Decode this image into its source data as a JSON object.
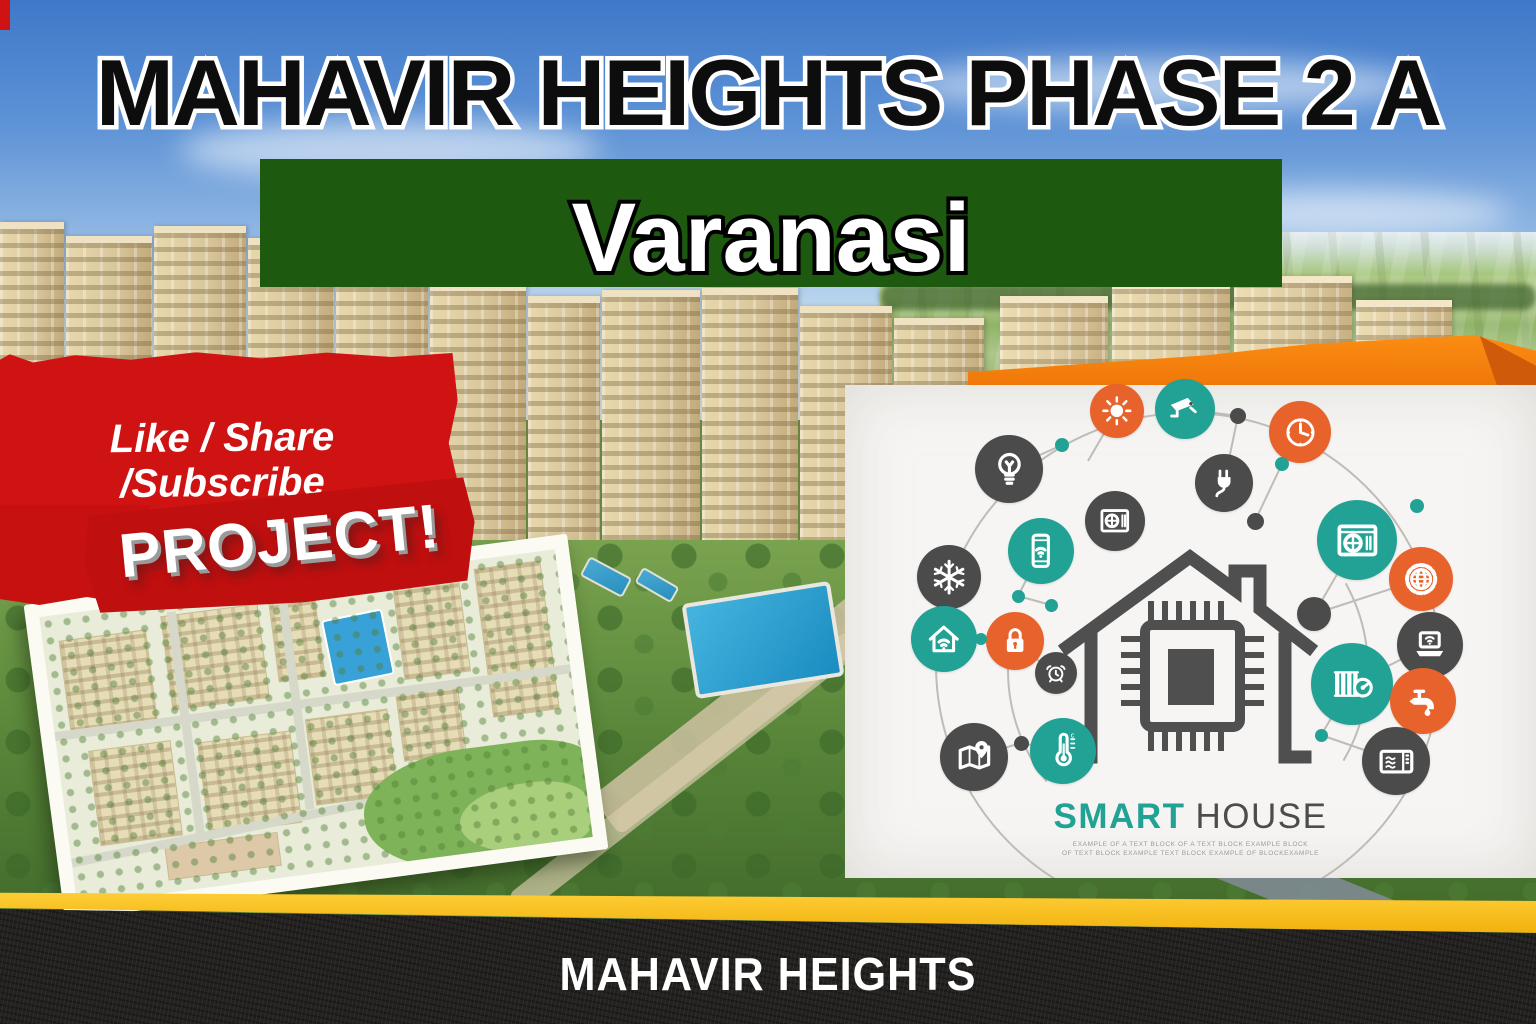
{
  "header": {
    "title": "MAHAVIR HEIGHTS PHASE 2 A"
  },
  "location_banner": {
    "text": "Varanasi",
    "bg_color": "#1d5a10"
  },
  "cta_banner": {
    "text": "Like / Share /Subscribe",
    "bg_color": "#ce1312"
  },
  "ribbon": {
    "text": "PROJECT!"
  },
  "footer": {
    "brand": "MAHAVIR HEIGHTS",
    "stripe_color": "#f3b90e",
    "bg_color": "#242220"
  },
  "smart_house": {
    "title_accent": "SMART",
    "title_rest": "HOUSE",
    "caption_line1": "EXAMPLE OF A TEXT BLOCK OF A TEXT BLOCK EXAMPLE BLOCK",
    "caption_line2": "OF TEXT BLOCK EXAMPLE TEXT BLOCK EXAMPLE OF BLOCKEXAMPLE",
    "colors": {
      "teal": "#21a295",
      "orange": "#e8622b",
      "dark": "#4b4b4b",
      "card_bg": "#f6f5f3"
    },
    "icons": [
      {
        "name": "light-bulb",
        "color": "dark",
        "x": 164,
        "y": 84,
        "d": 68
      },
      {
        "name": "sun",
        "color": "orange",
        "x": 272,
        "y": 26,
        "d": 54
      },
      {
        "name": "cctv-camera",
        "color": "teal",
        "x": 340,
        "y": 24,
        "d": 60
      },
      {
        "name": "clock",
        "color": "orange",
        "x": 455,
        "y": 47,
        "d": 62
      },
      {
        "name": "power-plug",
        "color": "dark",
        "x": 379,
        "y": 98,
        "d": 58
      },
      {
        "name": "ac-vent",
        "color": "dark",
        "x": 270,
        "y": 136,
        "d": 60
      },
      {
        "name": "smartphone-wifi",
        "color": "teal",
        "x": 196,
        "y": 166,
        "d": 66
      },
      {
        "name": "snowflake",
        "color": "dark",
        "x": 104,
        "y": 192,
        "d": 64
      },
      {
        "name": "air-conditioner",
        "color": "teal",
        "x": 512,
        "y": 155,
        "d": 80
      },
      {
        "name": "gear-globe",
        "color": "orange",
        "x": 576,
        "y": 194,
        "d": 64
      },
      {
        "name": "smart-home-wifi",
        "color": "teal",
        "x": 99,
        "y": 254,
        "d": 66
      },
      {
        "name": "padlock",
        "color": "orange",
        "x": 170,
        "y": 256,
        "d": 58
      },
      {
        "name": "alarm-clock",
        "color": "dark",
        "x": 211,
        "y": 288,
        "d": 42
      },
      {
        "name": "map-location",
        "color": "dark",
        "x": 129,
        "y": 372,
        "d": 68
      },
      {
        "name": "thermometer",
        "color": "teal",
        "x": 218,
        "y": 366,
        "d": 66
      },
      {
        "name": "radiator",
        "color": "teal",
        "x": 507,
        "y": 299,
        "d": 82
      },
      {
        "name": "laptop-wifi",
        "color": "dark",
        "x": 585,
        "y": 260,
        "d": 66
      },
      {
        "name": "water-tap",
        "color": "orange",
        "x": 578,
        "y": 316,
        "d": 66
      },
      {
        "name": "microwave",
        "color": "dark",
        "x": 551,
        "y": 376,
        "d": 68
      },
      {
        "name": "hub-node",
        "color": "dark",
        "x": 469,
        "y": 229,
        "d": 34
      }
    ],
    "dots": [
      {
        "color": "teal",
        "x": 217,
        "y": 60,
        "d": 14
      },
      {
        "color": "teal",
        "x": 437,
        "y": 79,
        "d": 14
      },
      {
        "color": "teal",
        "x": 572,
        "y": 121,
        "d": 14
      },
      {
        "color": "teal",
        "x": 173,
        "y": 211,
        "d": 13
      },
      {
        "color": "teal",
        "x": 206,
        "y": 220,
        "d": 13
      },
      {
        "color": "teal",
        "x": 136,
        "y": 254,
        "d": 12
      },
      {
        "color": "teal",
        "x": 476,
        "y": 350,
        "d": 13
      },
      {
        "color": "dark",
        "x": 393,
        "y": 31,
        "d": 16
      },
      {
        "color": "dark",
        "x": 410,
        "y": 136,
        "d": 17
      },
      {
        "color": "dark",
        "x": 176,
        "y": 358,
        "d": 15
      }
    ]
  }
}
